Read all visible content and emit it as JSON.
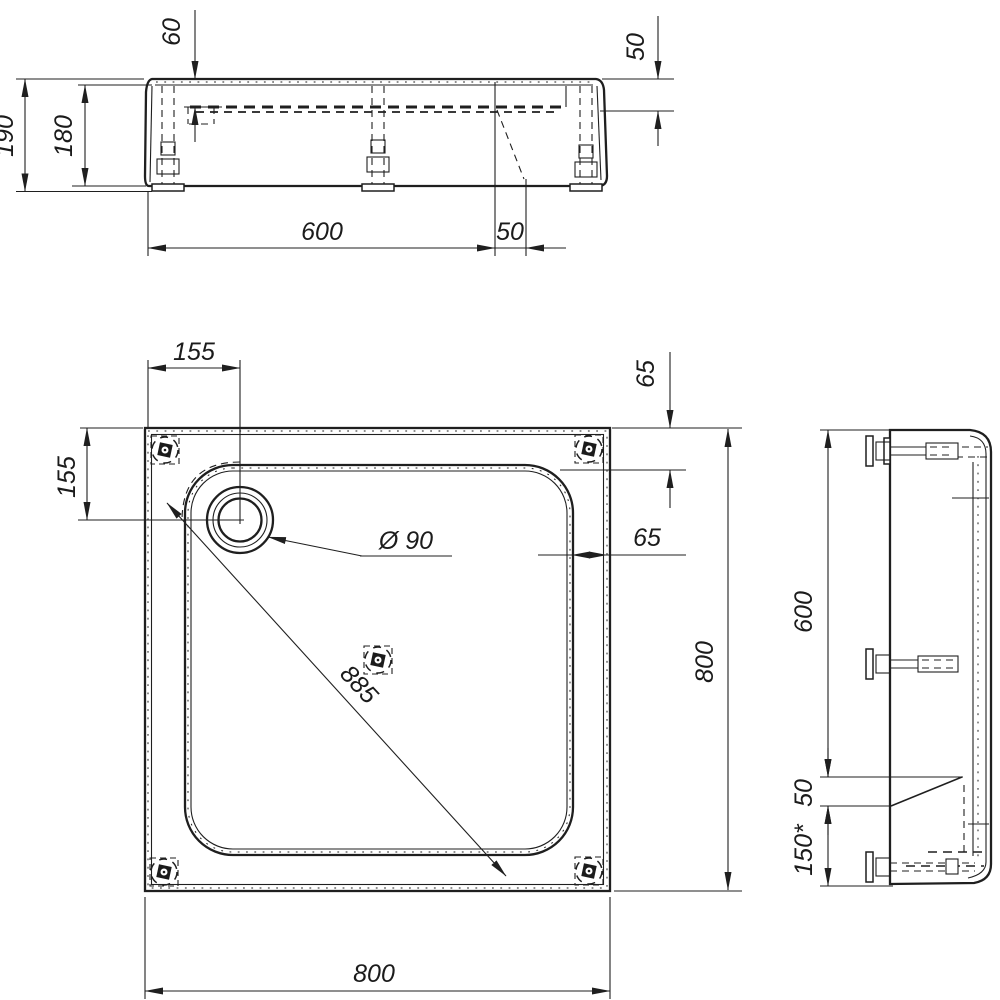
{
  "drawing_type": "technical-drawing-shower-tray",
  "colors": {
    "line": "#1f1f1f",
    "background": "#ffffff"
  },
  "views": {
    "front": {
      "dims": {
        "depth": "60",
        "height_total": "190",
        "height_body": "180",
        "length": "600",
        "offset": "50",
        "drop": "50"
      }
    },
    "plan": {
      "dims": {
        "drain_offset_x": "155",
        "drain_offset_y": "155",
        "corner_offset": "65",
        "rim_width": "65",
        "drain_diameter": "Ø 90",
        "diagonal": "885",
        "width": "800",
        "length": "800"
      }
    },
    "side": {
      "dims": {
        "upper": "600",
        "slope": "50",
        "lower": "150*"
      }
    }
  }
}
